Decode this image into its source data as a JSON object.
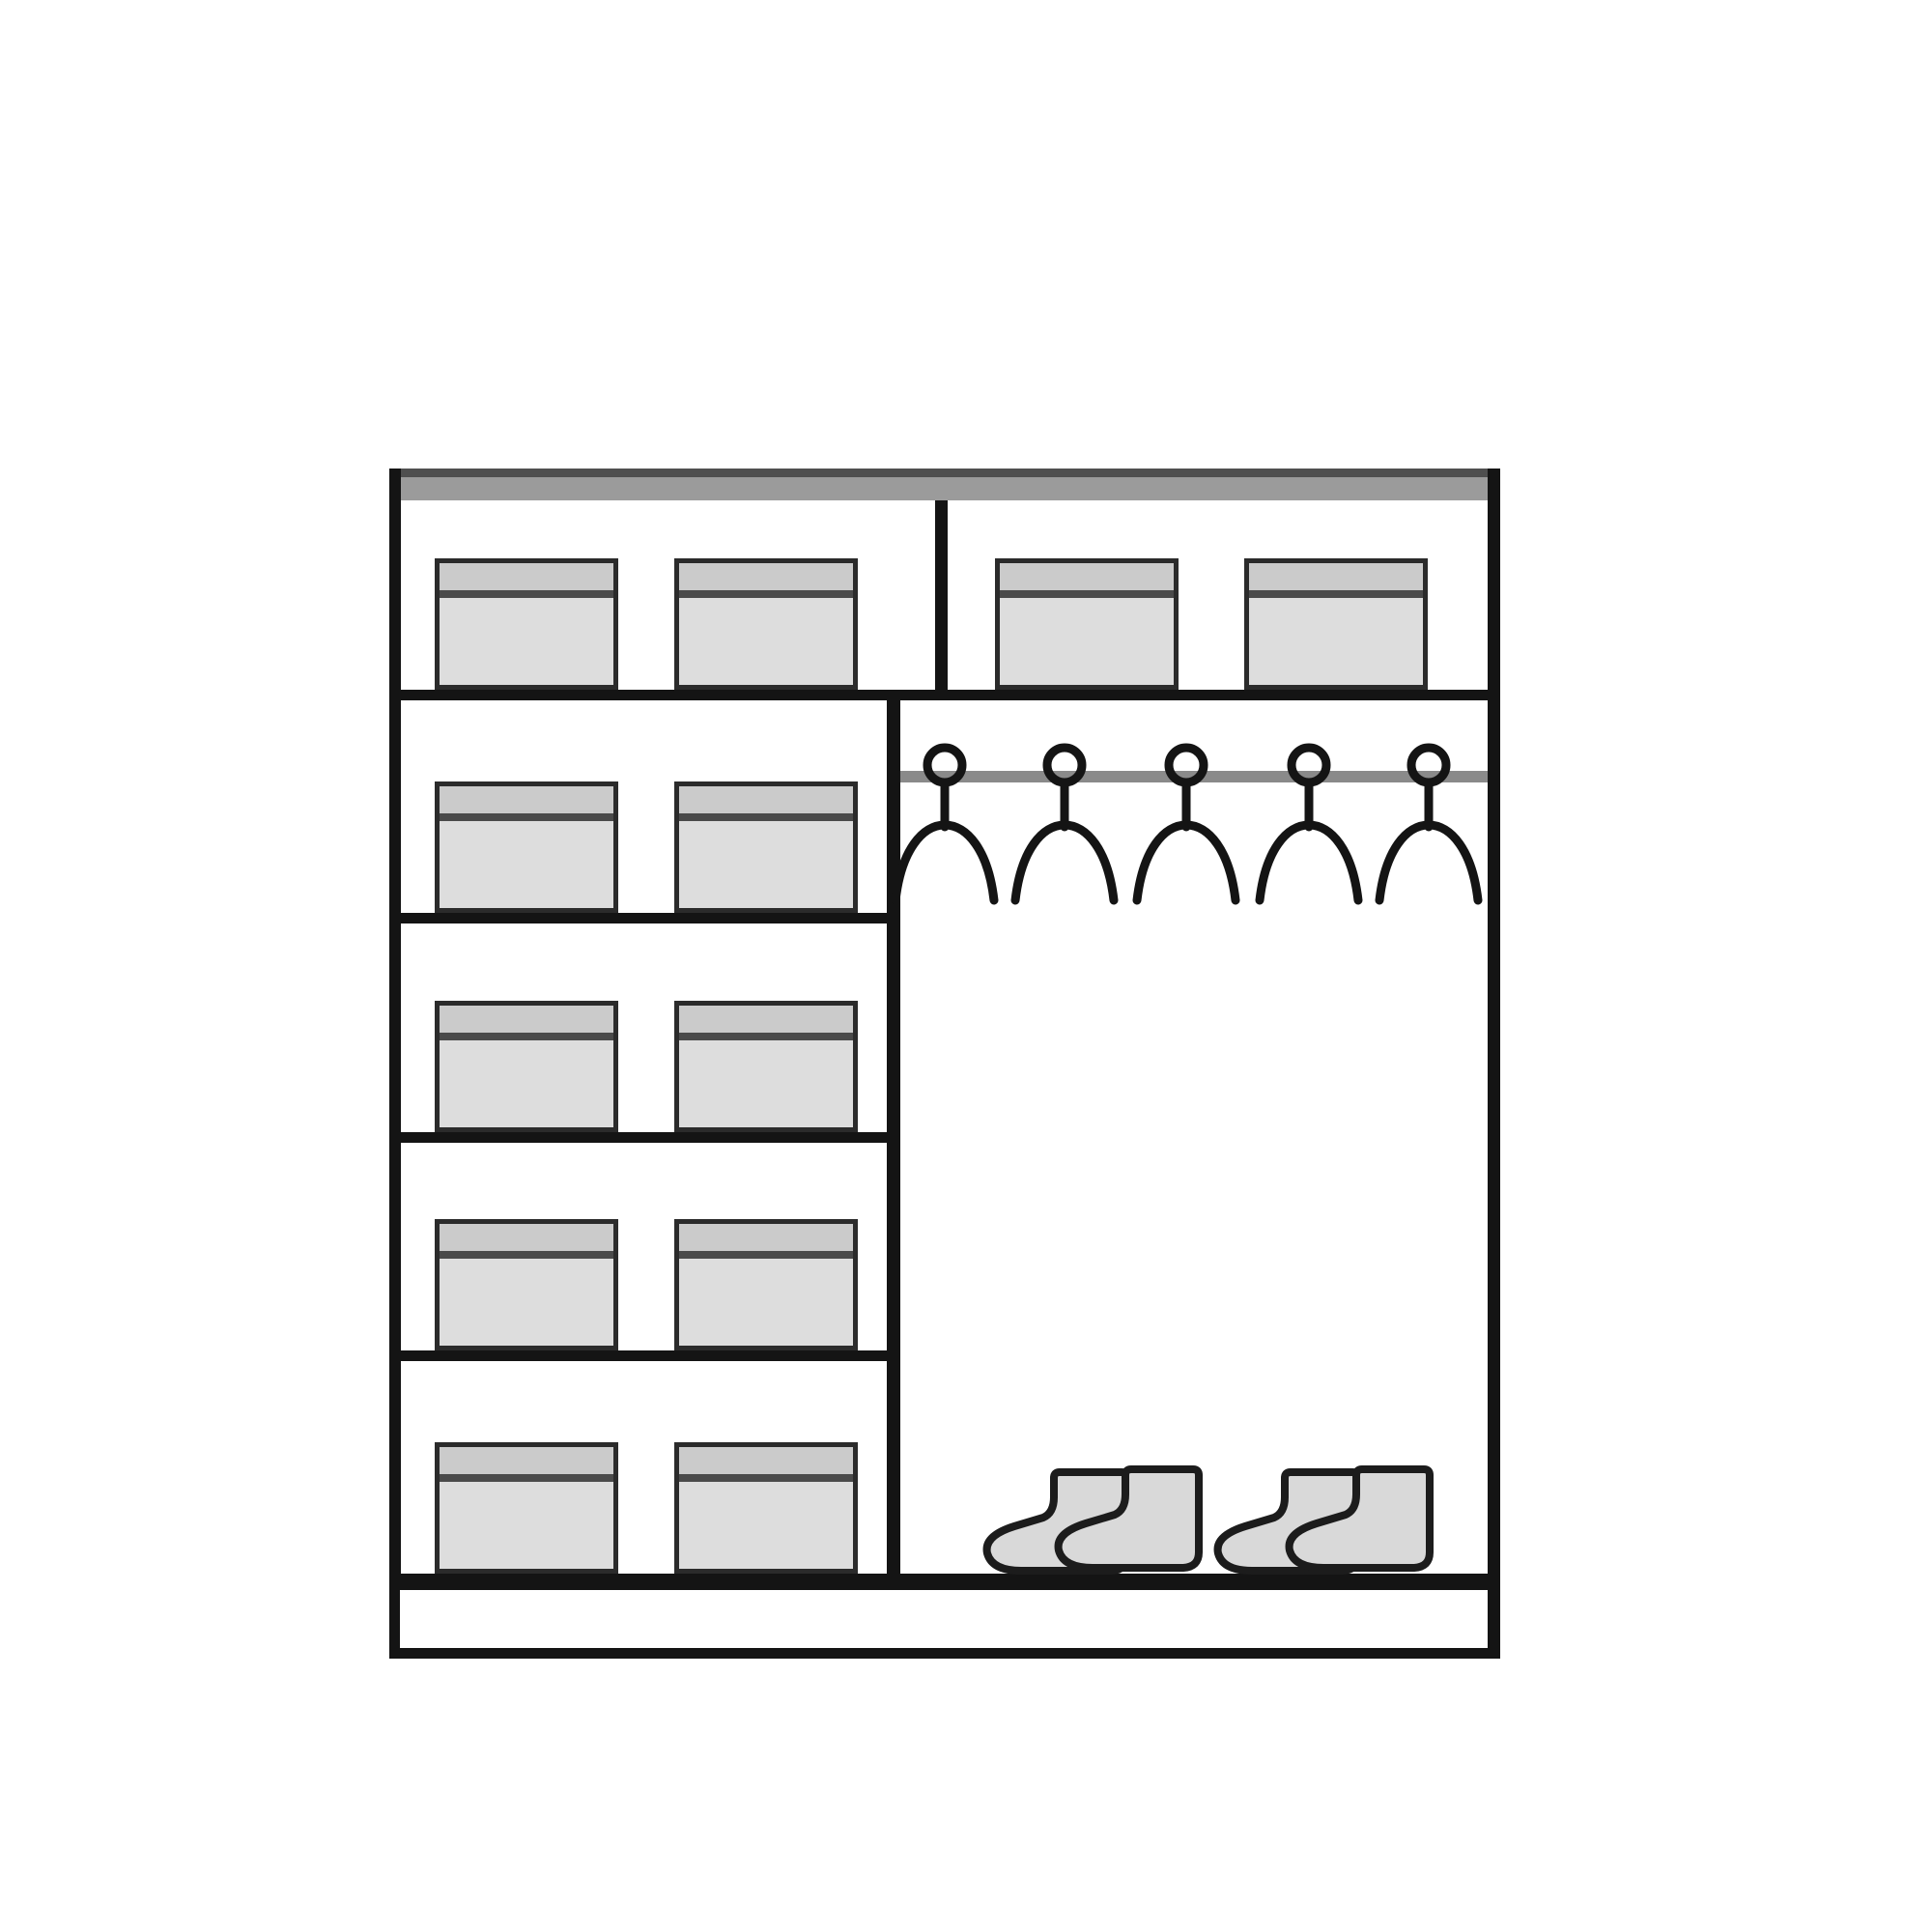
{
  "title": "Wardrobe interior layout diagram",
  "diagram": {
    "kind": "wardrobe-internal-storage-plan",
    "colors": {
      "background": "#ffffff",
      "outline": "#141414",
      "top_panel": "#9b9b9b",
      "top_panel_edge": "#4f4f4f",
      "box_border": "#2b2b2b",
      "box_lid": "#cbcbcb",
      "box_lid_line": "#4a4a4a",
      "box_body": "#dddddd",
      "rail": "#8a8a8a",
      "boot_fill": "#d9d9d9",
      "boot_outline": "#1c1c1c"
    },
    "top_shelf": {
      "compartments": 2,
      "boxes_per_compartment": 2
    },
    "left_column": {
      "shelf_rows": 4,
      "boxes_per_row": 2
    },
    "right_section": {
      "hangers": 5,
      "boot_pairs": 2
    },
    "totals": {
      "storage_boxes": 12
    }
  }
}
